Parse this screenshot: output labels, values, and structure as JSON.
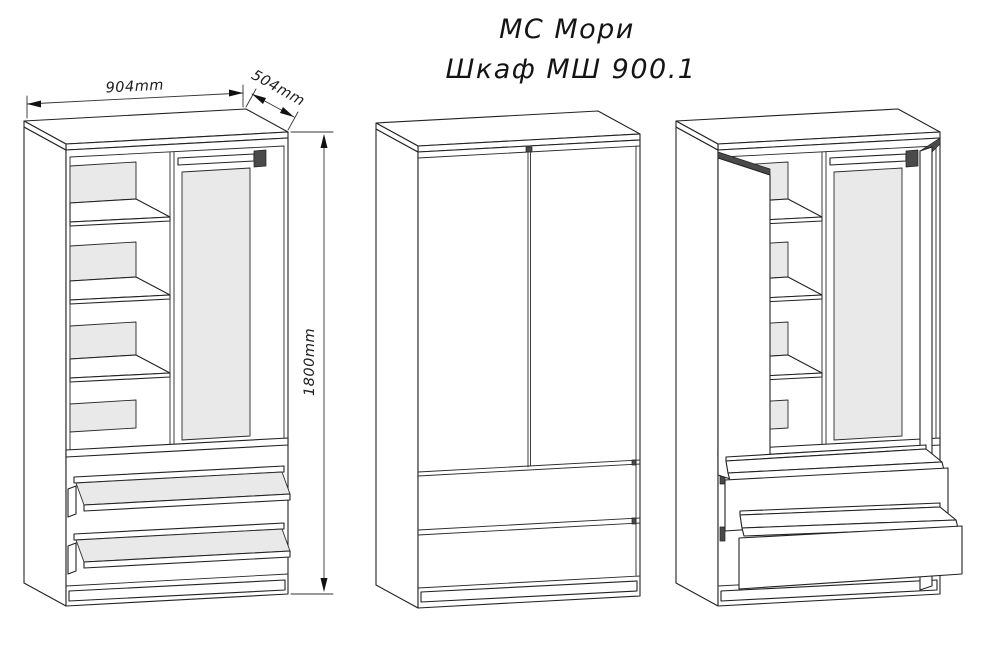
{
  "title": {
    "line1": "МС Мори",
    "line2": "Шкаф МШ 900.1"
  },
  "dimensions": {
    "width": "904mm",
    "depth": "504mm",
    "height": "1800mm"
  },
  "colors": {
    "line": "#222222",
    "panel_gray": "#e9e9e9",
    "dark_accent": "#4a4a4a",
    "background": "#ffffff"
  }
}
